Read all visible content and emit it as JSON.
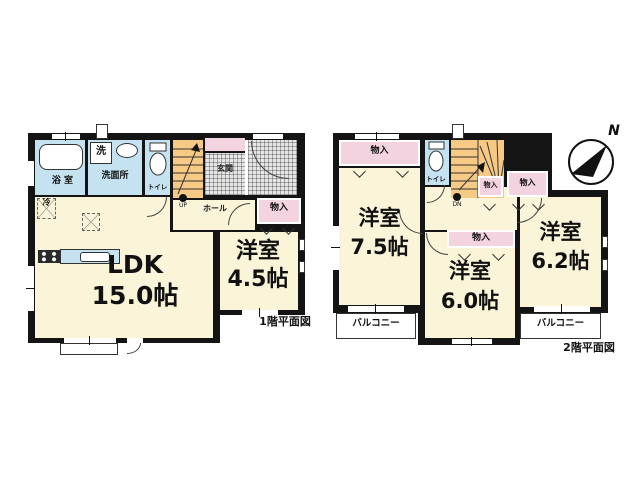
{
  "colors": {
    "wall": "#141414",
    "room_cream": "#FAF4D8",
    "water_blue": "#C4E2EF",
    "stairs_orange": "#F6C985",
    "storage_pink": "#F4D3E0"
  },
  "floor1": {
    "title": "1階平面図",
    "ldk": {
      "name": "LDK",
      "size": "15.0帖"
    },
    "yoshitsu": {
      "name": "洋室",
      "size": "4.5帖"
    },
    "bath": "浴 室",
    "washer": "洗",
    "washroom": "洗面所",
    "toilet": "トイレ",
    "hall": "ホール",
    "closet": "物入",
    "entrance": "玄関",
    "fridge": "冷",
    "stairs_dir": "UP"
  },
  "floor2": {
    "title": "2階平面図",
    "room_a": {
      "name": "洋室",
      "size": "7.5帖"
    },
    "room_b": {
      "name": "洋室",
      "size": "6.0帖"
    },
    "room_c": {
      "name": "洋室",
      "size": "6.2帖"
    },
    "toilet": "トイレ",
    "closet_top": "物入",
    "closet_hall_1": "物入",
    "closet_hall_2": "物入",
    "closet_mid": "物入",
    "balcony_left": "バルコニー",
    "balcony_right": "バルコニー",
    "stairs_dir": "DN",
    "compass": "N"
  }
}
